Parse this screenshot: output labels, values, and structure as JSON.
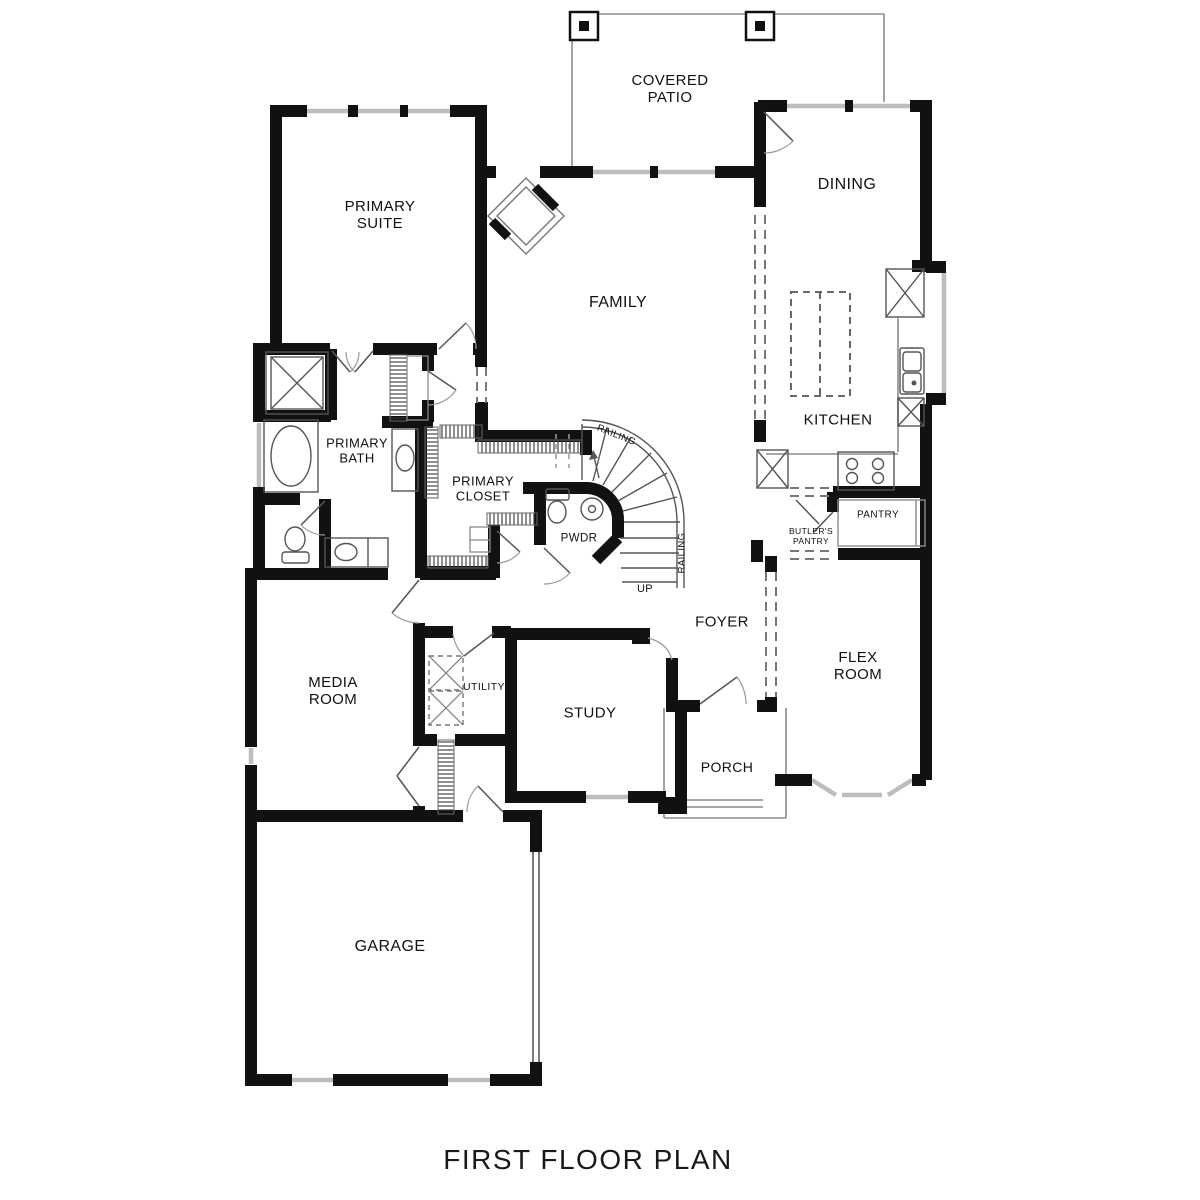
{
  "plan": {
    "title": "FIRST FLOOR PLAN",
    "labels": {
      "covered_patio": "COVERED\nPATIO",
      "primary_suite": "PRIMARY\nSUITE",
      "dining": "DINING",
      "family": "FAMILY",
      "kitchen": "KITCHEN",
      "primary_bath": "PRIMARY\nBATH",
      "primary_closet": "PRIMARY\nCLOSET",
      "pwdr": "PWDR",
      "railing_top": "RAILING",
      "railing_side": "RAILING",
      "up": "UP",
      "butlers_pantry": "BUTLER'S\nPANTRY",
      "pantry": "PANTRY",
      "foyer": "FOYER",
      "flex_room": "FLEX\nROOM",
      "media_room": "MEDIA\nROOM",
      "utility": "UTILITY",
      "study": "STUDY",
      "porch": "PORCH",
      "garage": "GARAGE"
    },
    "colors": {
      "wall": "#111111",
      "window": "#bdbdbd",
      "thin_line": "#8c8c8c",
      "background": "#ffffff"
    }
  }
}
